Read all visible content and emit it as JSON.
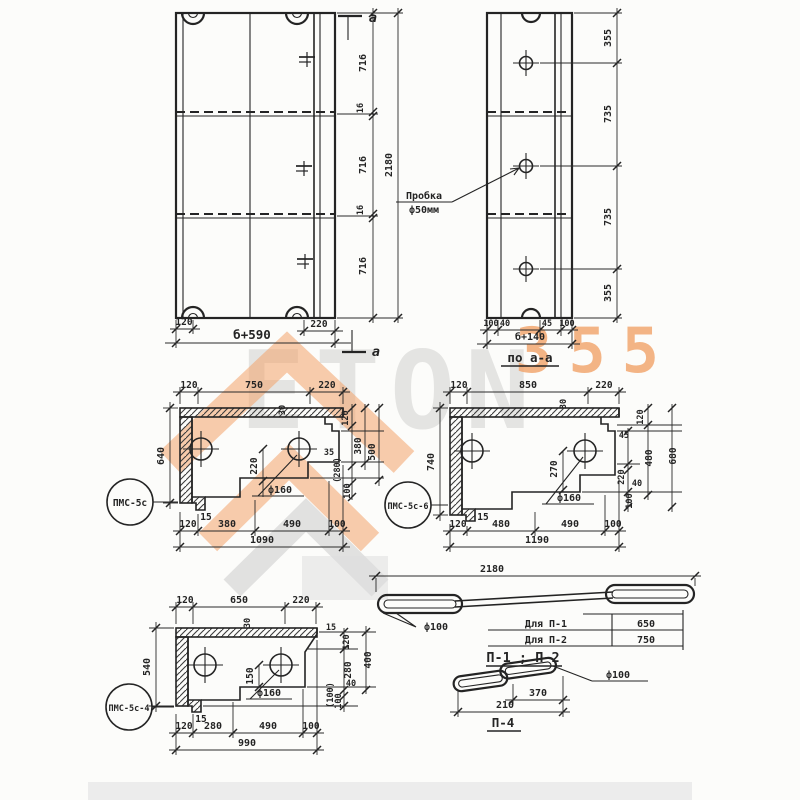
{
  "watermark": {
    "word": "ETON",
    "number": "355"
  },
  "plan": {
    "section_letter": "a",
    "right_chain": [
      "716",
      "16",
      "716",
      "16",
      "716"
    ],
    "right_total": "2180",
    "bottom": {
      "left": "120",
      "mid": "б+590",
      "right": "220"
    }
  },
  "section": {
    "plug1": "Пробка",
    "plug2": "ф50мм",
    "right_chain": [
      "355",
      "735",
      "735",
      "355"
    ],
    "bottom": [
      "100",
      "40",
      "45",
      "100"
    ],
    "total": "б+140",
    "caption": "по а-а"
  },
  "p1": {
    "label": "ПМС-5с",
    "top": [
      "120",
      "750",
      "220"
    ],
    "height": "640",
    "slab": "30",
    "hole": "ф160",
    "holev": "220",
    "step": "15",
    "right": [
      "120",
      "35",
      "380",
      "(280)",
      "100",
      "(40)"
    ],
    "outer": "500",
    "bottom": [
      "120",
      "380",
      "490",
      "100"
    ],
    "total": "1090"
  },
  "p2": {
    "label": "ПМС-5с-6",
    "top": [
      "120",
      "850",
      "220"
    ],
    "height": "740",
    "slab": "30",
    "hole": "ф160",
    "holev": "270",
    "step": "15",
    "right": [
      "120",
      "45",
      "480",
      "220",
      "40",
      "100"
    ],
    "outer": "680",
    "bottom": [
      "120",
      "480",
      "490",
      "100"
    ],
    "total": "1190"
  },
  "p3": {
    "label": "ПМС-5с-4",
    "top": [
      "120",
      "650",
      "220"
    ],
    "height": "540",
    "slab": "30",
    "hole": "ф160",
    "holev": "150",
    "step": "15",
    "right": [
      "15",
      "120",
      "280",
      "(100)",
      "40",
      "100"
    ],
    "outer": "400",
    "bottom": [
      "120",
      "280",
      "490",
      "100"
    ],
    "total": "990"
  },
  "loops": {
    "total": "2180",
    "dia": "ф100",
    "rows": [
      {
        "label": "Для П-1",
        "value": "650"
      },
      {
        "label": "Для П-2",
        "value": "750"
      }
    ],
    "caption": "П-1 ; П-2",
    "p4": {
      "top": "370",
      "bottom": "210",
      "dia": "ф100",
      "caption": "П-4"
    }
  }
}
